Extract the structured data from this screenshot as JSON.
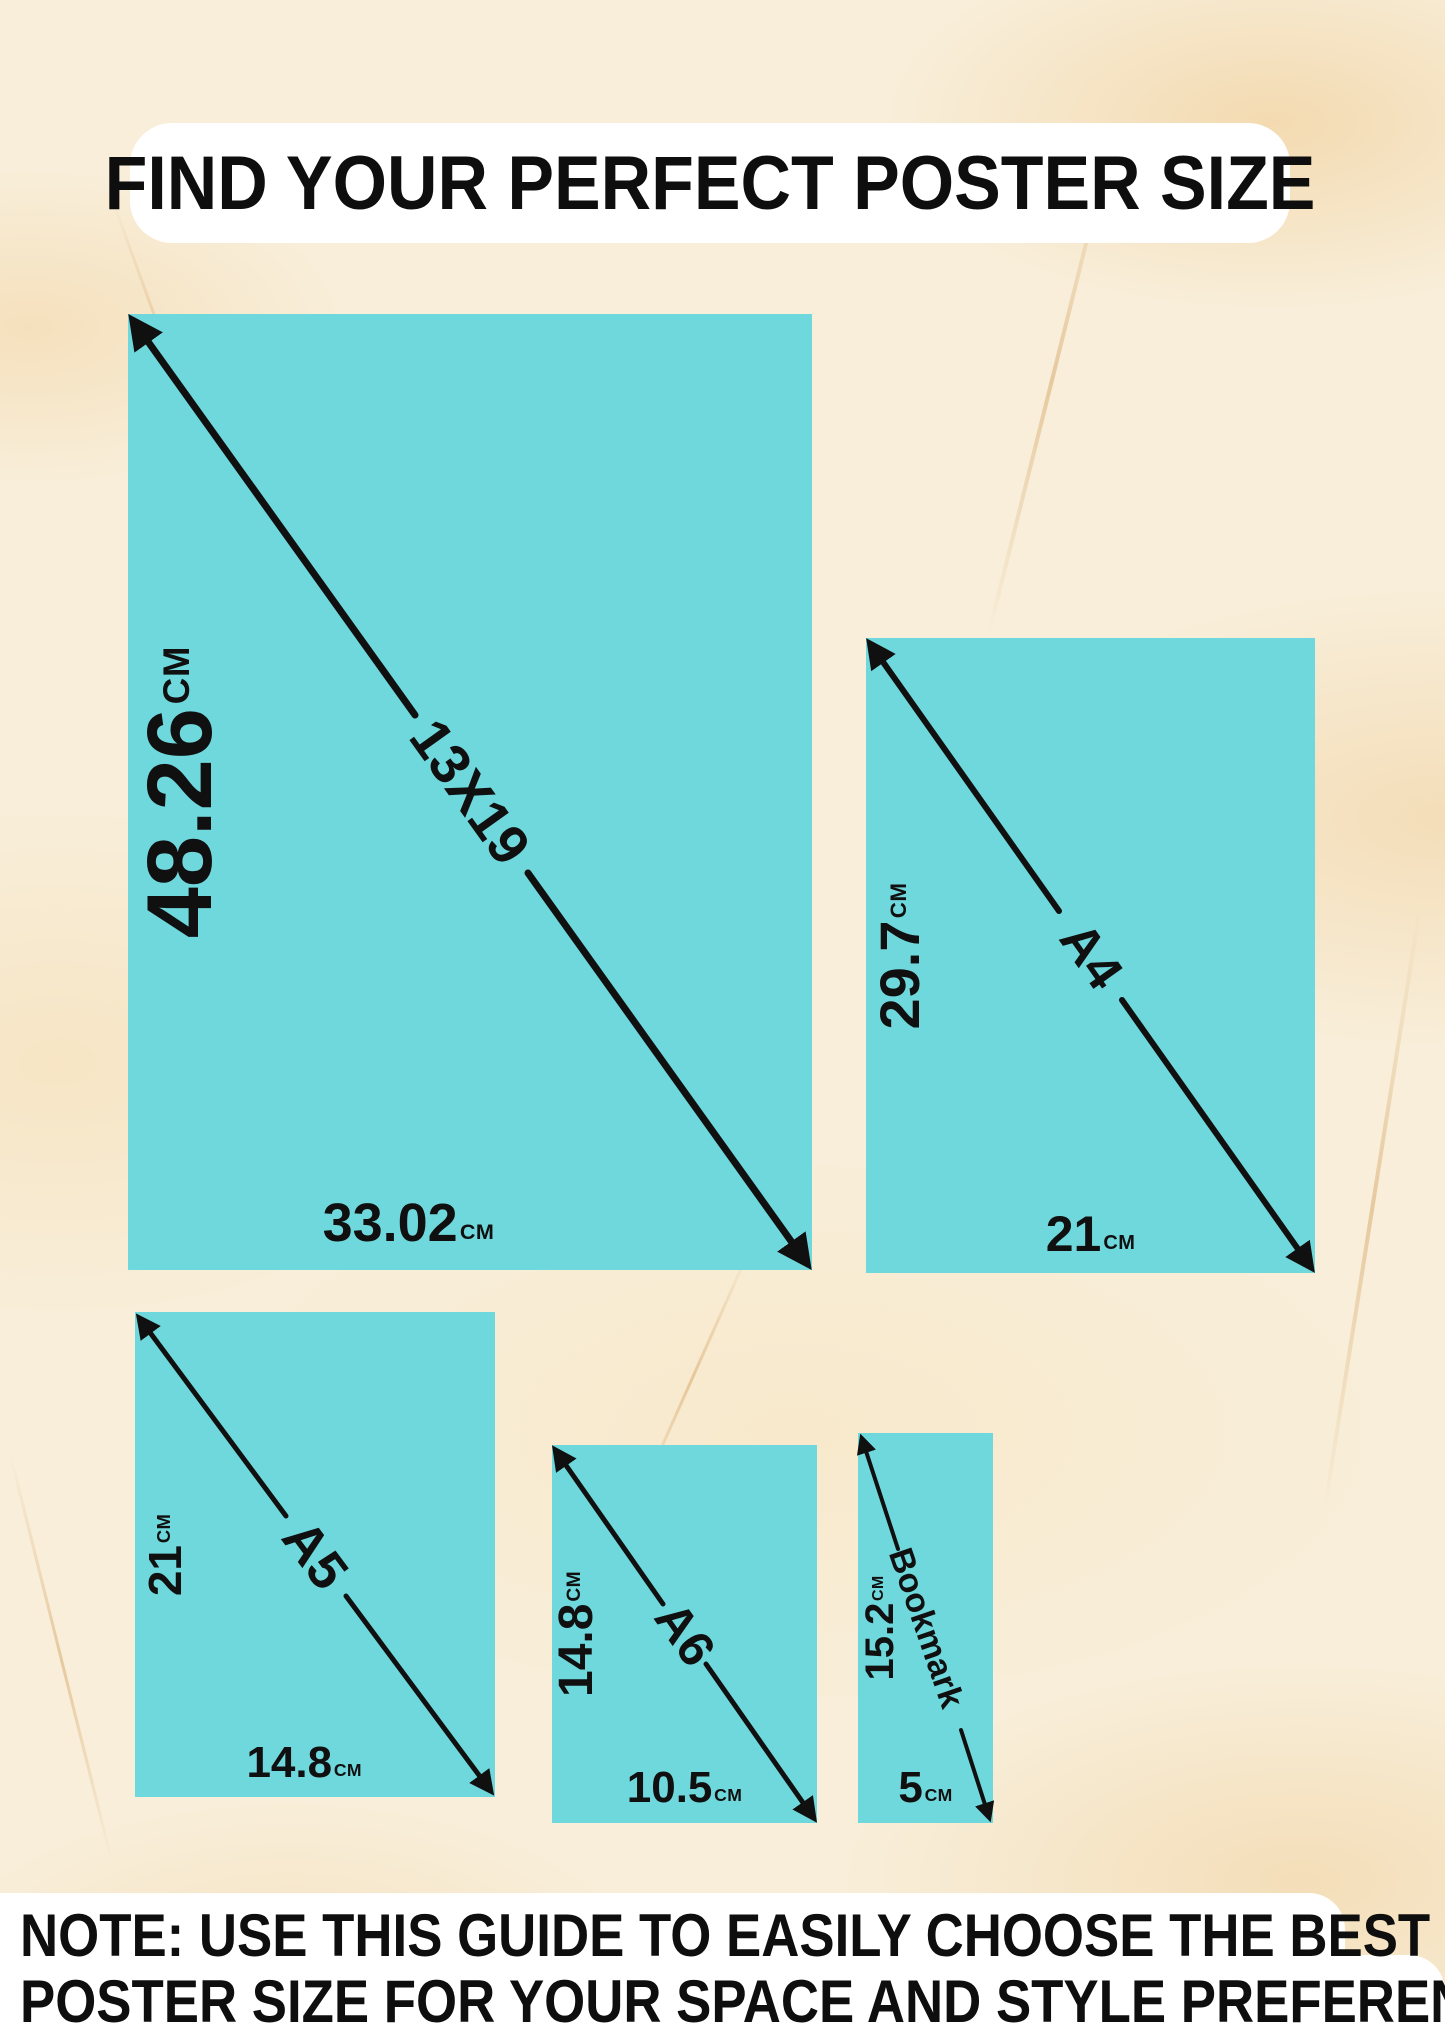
{
  "title": "FIND YOUR PERFECT POSTER SIZE",
  "note": {
    "line1": "NOTE: USE THIS GUIDE TO EASILY CHOOSE THE BEST",
    "line2": "POSTER SIZE FOR YOUR SPACE AND STYLE PREFERENCES"
  },
  "colors": {
    "poster_fill": "#6fd8dd",
    "ink": "#101010",
    "panel": "#ffffff",
    "background": "#f8eed9",
    "vein": "#d8aa6e"
  },
  "sizes": [
    {
      "name": "13X19",
      "height": "48.26",
      "width": "33.02",
      "unit": "CM"
    },
    {
      "name": "A4",
      "height": "29.7",
      "width": "21",
      "unit": "CM"
    },
    {
      "name": "A5",
      "height": "21",
      "width": "14.8",
      "unit": "CM"
    },
    {
      "name": "A6",
      "height": "14.8",
      "width": "10.5",
      "unit": "CM"
    },
    {
      "name": "Bookmark",
      "height": "15.2",
      "width": "5",
      "unit": "CM"
    }
  ]
}
